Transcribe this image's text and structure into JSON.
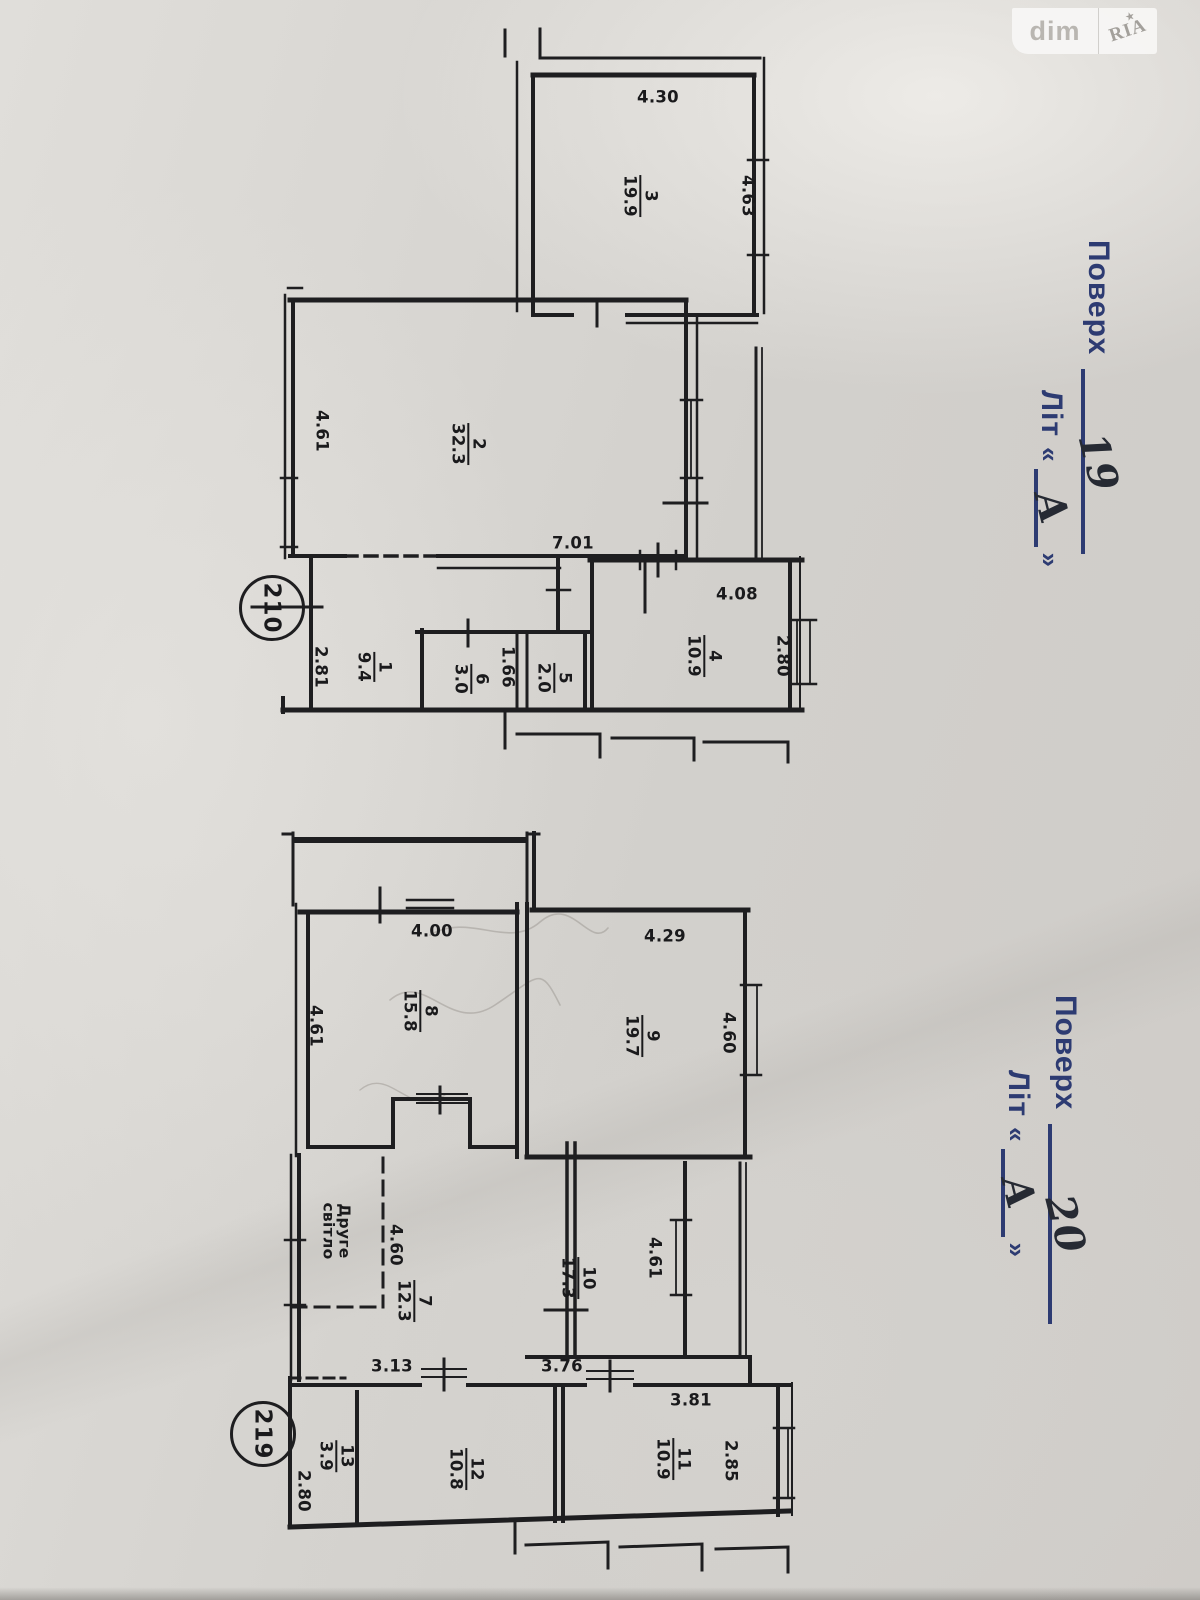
{
  "watermark": {
    "left": "dim",
    "right": "RIA",
    "star": "★"
  },
  "stamp_19": {
    "floor_label": "Поверх",
    "floor_value": "19",
    "lit_label": "Літ",
    "open_quote": "«",
    "lit_value": "А",
    "close_quote": "»"
  },
  "stamp_20": {
    "floor_label": "Поверх",
    "floor_value": "20",
    "lit_label": "Літ",
    "open_quote": "«",
    "lit_value": "А",
    "close_quote": "»"
  },
  "plan_19": {
    "circle": "210",
    "rooms": {
      "r3": {
        "n": "3",
        "a": "19.9"
      },
      "r2": {
        "n": "2",
        "a": "32.3"
      },
      "r1": {
        "n": "1",
        "a": "9.4"
      },
      "r6": {
        "n": "6",
        "a": "3.0"
      },
      "r5": {
        "n": "5",
        "a": "2.0"
      },
      "r4": {
        "n": "4",
        "a": "10.9"
      }
    },
    "dims": {
      "d430": "4.30",
      "d463": "4.63",
      "d461": "4.61",
      "d701": "7.01",
      "d408": "4.08",
      "d280": "2.80",
      "d281": "2.81",
      "d166": "1.66"
    }
  },
  "plan_20": {
    "circle": "219",
    "void_line1": "Друге",
    "void_line2": "світло",
    "rooms": {
      "r8": {
        "n": "8",
        "a": "15.8"
      },
      "r9": {
        "n": "9",
        "a": "19.7"
      },
      "r7": {
        "n": "7",
        "a": "12.3"
      },
      "r10": {
        "n": "10",
        "a": "17.3"
      },
      "r13": {
        "n": "13",
        "a": "3.9"
      },
      "r12": {
        "n": "12",
        "a": "10.8"
      },
      "r11": {
        "n": "11",
        "a": "10.9"
      }
    },
    "dims": {
      "d400": "4.00",
      "d429": "4.29",
      "d461_left": "4.61",
      "d460_right": "4.60",
      "d460_void": "4.60",
      "d461_shaft": "4.61",
      "d313": "3.13",
      "d376": "3.76",
      "d381": "3.81",
      "d285": "2.85",
      "d280": "2.80"
    }
  }
}
